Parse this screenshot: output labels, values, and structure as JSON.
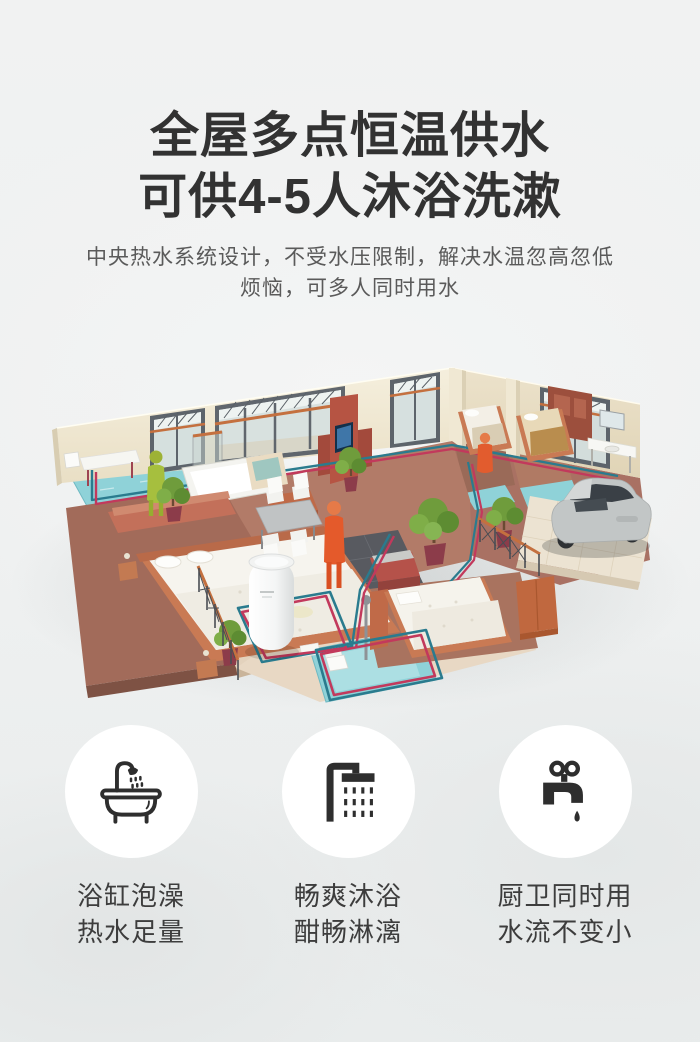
{
  "header": {
    "title_line1": "全屋多点恒温供水",
    "title_line2": "可供4-5人沐浴洗漱",
    "subtitle_line1": "中央热水系统设计，不受水压限制，解决水温忽高忽低",
    "subtitle_line2": "烦恼，可多人同时用水"
  },
  "illustration": {
    "objects": [
      "isometric-house-floorplan",
      "water-heater-cylinder",
      "hot-water-pipe",
      "cold-water-pipe",
      "resident-figure-green",
      "resident-figure-orange",
      "suv-car",
      "bonsai-plants",
      "beds-and-furniture",
      "blue-tile-bathrooms"
    ]
  },
  "features": [
    {
      "icon": "bathtub-icon",
      "line1": "浴缸泡澡",
      "line2": "热水足量"
    },
    {
      "icon": "shower-icon",
      "line1": "畅爽沐浴",
      "line2": "酣畅淋漓"
    },
    {
      "icon": "faucet-icon",
      "line1": "厨卫同时用",
      "line2": "水流不变小"
    }
  ],
  "colors": {
    "background": "#eff1f1",
    "title_text": "#323232",
    "subtitle_text": "#5a5a5a",
    "feature_circle_bg": "#ffffff",
    "feature_icon": "#2e2e2e",
    "feature_label": "#3d3d3d",
    "pipe_hot": "#c2395c",
    "pipe_cold": "#2a7b8e",
    "wall_cream": "#efe7d2",
    "floor_wood": "#a97163",
    "tile_blue": "#8fd2d8",
    "accent_orange": "#c4703f",
    "figure_green": "#a6bf3e",
    "figure_orange": "#e2572b",
    "car_silver": "#c2c6c6"
  }
}
